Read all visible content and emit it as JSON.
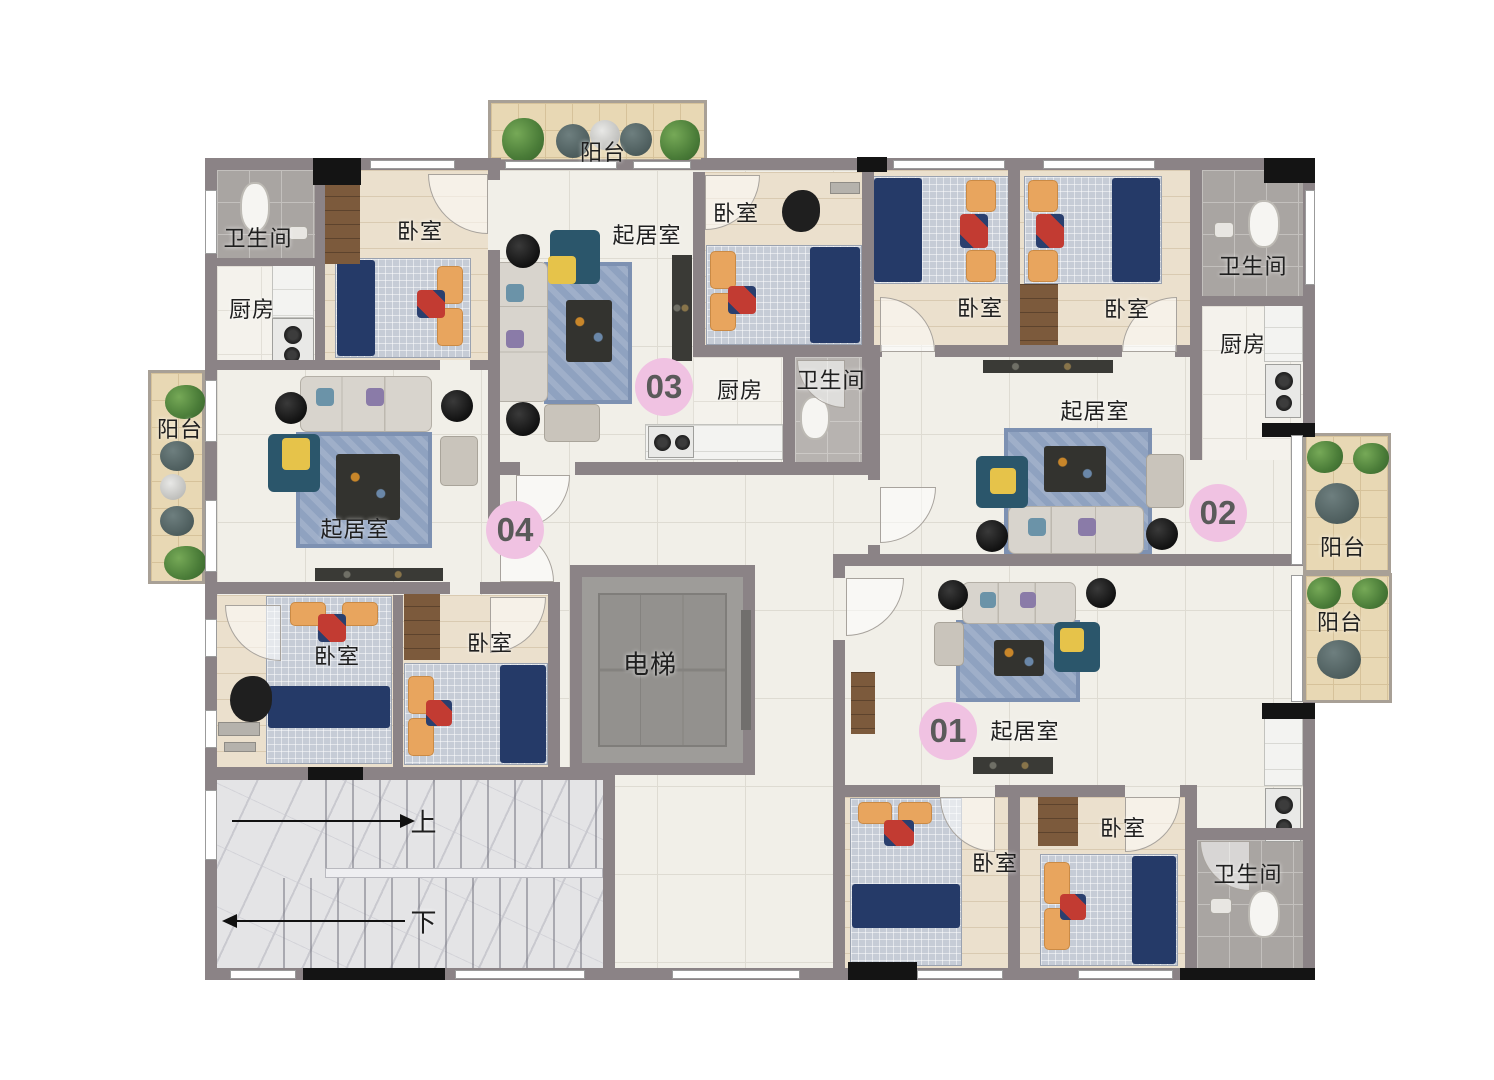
{
  "title": "apartment-floor-plan",
  "units": [
    {
      "badge": "01"
    },
    {
      "badge": "02"
    },
    {
      "badge": "03"
    },
    {
      "badge": "04"
    }
  ],
  "labels": [
    {
      "text": "卫生间"
    },
    {
      "text": "卧室"
    },
    {
      "text": "厨房"
    },
    {
      "text": "阳台"
    },
    {
      "text": "起居室"
    },
    {
      "text": "卧室"
    },
    {
      "text": "卧室"
    },
    {
      "text": "阳台"
    },
    {
      "text": "起居室"
    },
    {
      "text": "卧室"
    },
    {
      "text": "厨房"
    },
    {
      "text": "卫生间"
    },
    {
      "text": "卧室"
    },
    {
      "text": "卧室"
    },
    {
      "text": "卫生间"
    },
    {
      "text": "厨房"
    },
    {
      "text": "起居室"
    },
    {
      "text": "阳台"
    },
    {
      "text": "阳台"
    },
    {
      "text": "起居室"
    },
    {
      "text": "卧室"
    },
    {
      "text": "卧室"
    },
    {
      "text": "卫生间"
    },
    {
      "text": "电梯"
    },
    {
      "text": "上"
    },
    {
      "text": "下"
    }
  ],
  "colors": {
    "wall": "#8b8386",
    "column": "#141414",
    "tile_floor": "#f1efe8",
    "wood_floor": "#ebe0cd",
    "bath_floor": "#a9a5a2",
    "balcony_floor": "#e8d8b4",
    "stair_marble": "#e4e4e6",
    "rug_blue": "#8fa2c0",
    "blanket_navy": "#253a68",
    "pillow_orange": "#e8a55e",
    "sofa_gray": "#d8d4cd",
    "armchair_teal": "#2b566b",
    "accent_yellow": "#e6c34a",
    "badge_pink": "#f0c2e2",
    "label_text": "#1f1f1f"
  }
}
